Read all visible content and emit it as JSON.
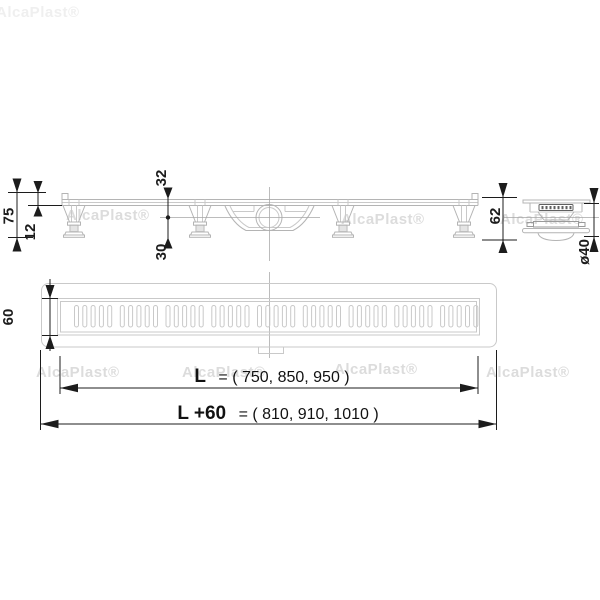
{
  "watermark": {
    "text": "AlcaPlast®"
  },
  "side_view": {
    "dim_total_height": "75",
    "dim_edge_height": "12",
    "dim_top_to_axis": "32",
    "dim_axis_to_bottom": "30",
    "dim_end_height": "62",
    "dim_outlet_diameter": "ø40"
  },
  "top_view": {
    "dim_width": "60"
  },
  "length_dims": {
    "l_label": "L",
    "l_values": "= ( 750, 850, 950 )",
    "l60_label": "L +60",
    "l60_values": "= ( 810, 910, 1010 )"
  },
  "colors": {
    "line": "#b4b4b4",
    "dimension": "#1c1c1c",
    "watermark": "#dcdcdc"
  }
}
